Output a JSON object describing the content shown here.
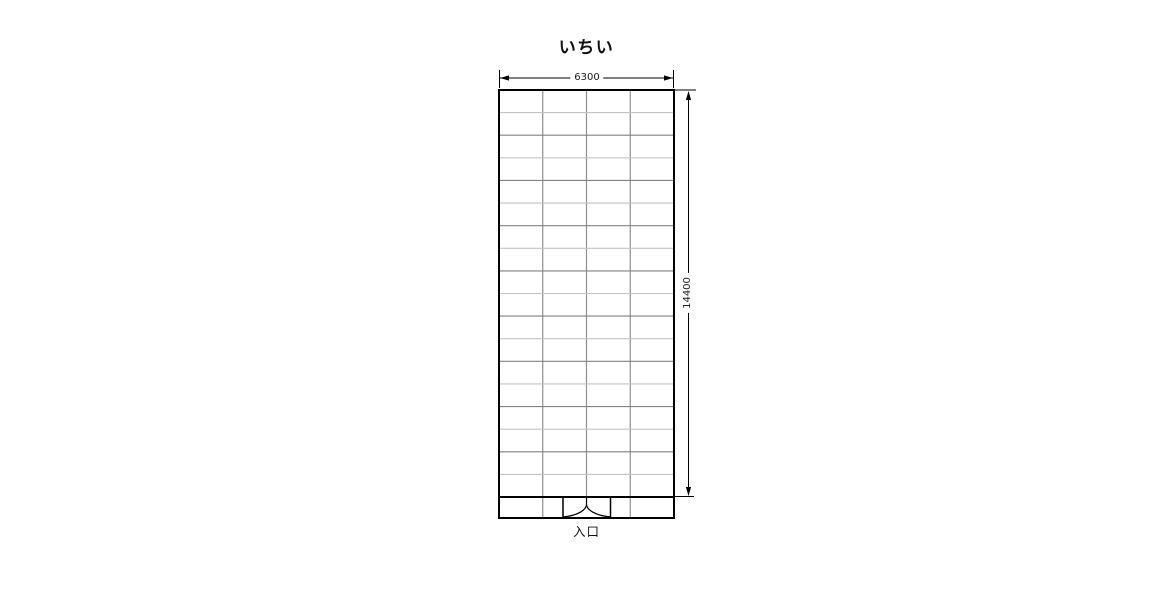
{
  "plan": {
    "title": "いちい",
    "entrance_label": "入口",
    "grid": {
      "rows": 18,
      "columns": 4
    },
    "dimensions": {
      "width_mm": "6300",
      "height_mm": "14400"
    },
    "colors": {
      "outline": "#000000",
      "grid_vertical": "#909090",
      "grid_horizontal_light": "#c4c4c4",
      "grid_horizontal_dark": "#828282",
      "background": "#ffffff"
    }
  }
}
